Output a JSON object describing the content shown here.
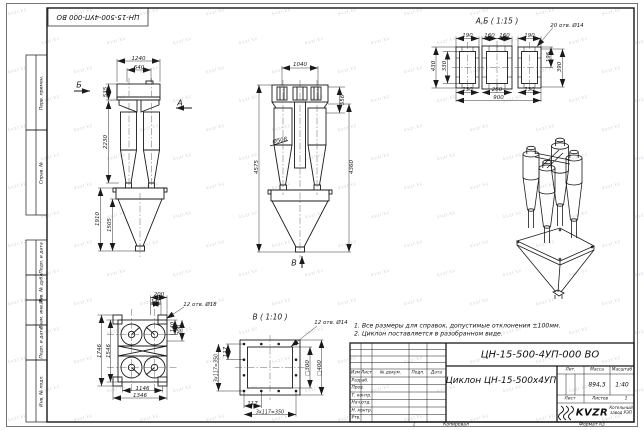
{
  "meta": {
    "doc_number": "ЦН-15-500-4УП-000 ВО",
    "title": "Циклон ЦН-15-500х4УП",
    "mass": "894,3",
    "scale": "1:40",
    "copied": "Копировал",
    "format": "Формат А3",
    "company_logo": "KVZR",
    "company_name": "Котельный завод РЭП"
  },
  "stamp_top_left": "ЦН-15-500-4УП-000 ВО",
  "notes": [
    "1. Все размеры для справок, допустимые отклонения ±100мм.",
    "2. Циклон поставляется в разобранном виде."
  ],
  "margin_labels": [
    "Перв. примен.",
    "Справ. №",
    "Подп. и дата",
    "Инв. № дубл.",
    "Взам. инв. №",
    "Подп. и дата",
    "Инв. № подл."
  ],
  "titleblock": {
    "cols": [
      "Изм",
      "Лист",
      "№ докум.",
      "Подп.",
      "Дата"
    ],
    "rows": [
      "Разраб.",
      "Пров.",
      "Т. контр.",
      "Нач.отд.",
      "Н. контр.",
      "Утв."
    ],
    "lit_label": "Лит.",
    "mass_label": "Масса",
    "scale_label": "Масштаб",
    "sheet_label": "Лист",
    "sheets_label": "Листов",
    "sheets_value": "1"
  },
  "watermark_text": "kvzr.kz",
  "labels": [
    {
      "t": "1240",
      "x": 138.5,
      "y": 58.5
    },
    {
      "t": "640",
      "x": 139,
      "y": 67.5
    },
    {
      "t": "535",
      "x": 106,
      "y": 92,
      "r": -90
    },
    {
      "t": "2230",
      "x": 106,
      "y": 142,
      "r": -90
    },
    {
      "t": "1910",
      "x": 98,
      "y": 219,
      "r": -90
    },
    {
      "t": "1505",
      "x": 110,
      "y": 225,
      "r": -90
    },
    {
      "t": "Б",
      "x": 79,
      "y": 85,
      "fs": 8,
      "n": "view-arrow-label-b"
    },
    {
      "t": "А",
      "x": 180,
      "y": 103,
      "fs": 8,
      "n": "view-arrow-label-a"
    },
    {
      "t": "1040",
      "x": 300,
      "y": 64.5
    },
    {
      "t": "556",
      "x": 343,
      "y": 100,
      "r": -90
    },
    {
      "t": "Ø508",
      "x": 280,
      "y": 141,
      "r": -12
    },
    {
      "t": "4575",
      "x": 256.5,
      "y": 167,
      "r": -90
    },
    {
      "t": "4360",
      "x": 351.5,
      "y": 167,
      "r": -90
    },
    {
      "t": "В",
      "x": 294,
      "y": 263,
      "fs": 8,
      "n": "view-arrow-label-v"
    },
    {
      "t": "А,Б ( 1:15 )",
      "x": 497,
      "y": 21,
      "fs": 7.5,
      "n": "detail-ab-title"
    },
    {
      "t": "20 отв. Ø14",
      "x": 567,
      "y": 25.5
    },
    {
      "t": "190",
      "x": 467.5,
      "y": 35.5
    },
    {
      "t": "160",
      "x": 489.5,
      "y": 35.5
    },
    {
      "t": "160",
      "x": 504.5,
      "y": 35.5
    },
    {
      "t": "190",
      "x": 529.5,
      "y": 35.5
    },
    {
      "t": "430",
      "x": 433.5,
      "y": 66,
      "r": -90
    },
    {
      "t": "330",
      "x": 445,
      "y": 66,
      "r": -90
    },
    {
      "t": "195",
      "x": 548.5,
      "y": 57,
      "r": -90
    },
    {
      "t": "390",
      "x": 560,
      "y": 67,
      "r": -90
    },
    {
      "t": "130",
      "x": 467.5,
      "y": 90
    },
    {
      "t": "260",
      "x": 497,
      "y": 90
    },
    {
      "t": "130",
      "x": 529.5,
      "y": 90
    },
    {
      "t": "900",
      "x": 498.5,
      "y": 98
    },
    {
      "t": "200",
      "x": 159,
      "y": 295
    },
    {
      "t": "140",
      "x": 156,
      "y": 301.5
    },
    {
      "t": "12 отв. Ø18",
      "x": 200,
      "y": 305
    },
    {
      "t": "140",
      "x": 172.5,
      "y": 327,
      "r": -90
    },
    {
      "t": "200",
      "x": 180,
      "y": 330,
      "r": -90
    },
    {
      "t": "1746",
      "x": 99.5,
      "y": 350.5,
      "r": -90
    },
    {
      "t": "1546",
      "x": 108.5,
      "y": 350.5,
      "r": -90
    },
    {
      "t": "1146",
      "x": 142.5,
      "y": 388.5
    },
    {
      "t": "1346",
      "x": 140,
      "y": 396
    },
    {
      "t": "В ( 1:10 )",
      "x": 270,
      "y": 317,
      "fs": 7.5,
      "n": "detail-v-title"
    },
    {
      "t": "12 отв. Ø14",
      "x": 331,
      "y": 322.5
    },
    {
      "t": "117",
      "x": 226,
      "y": 352,
      "r": -90
    },
    {
      "t": "3х117=350",
      "x": 216.5,
      "y": 367.5,
      "r": -90,
      "fs": 4.8
    },
    {
      "t": "□300",
      "x": 308,
      "y": 367.5,
      "r": -90
    },
    {
      "t": "□400",
      "x": 319.5,
      "y": 367.5,
      "r": -90
    },
    {
      "t": "117",
      "x": 252.5,
      "y": 404
    },
    {
      "t": "3х117=350",
      "x": 270,
      "y": 412.5,
      "fs": 4.8
    },
    {
      "t": "1",
      "x": 414,
      "y": 424.5,
      "fs": 4.5,
      "n": "zone-number"
    }
  ]
}
